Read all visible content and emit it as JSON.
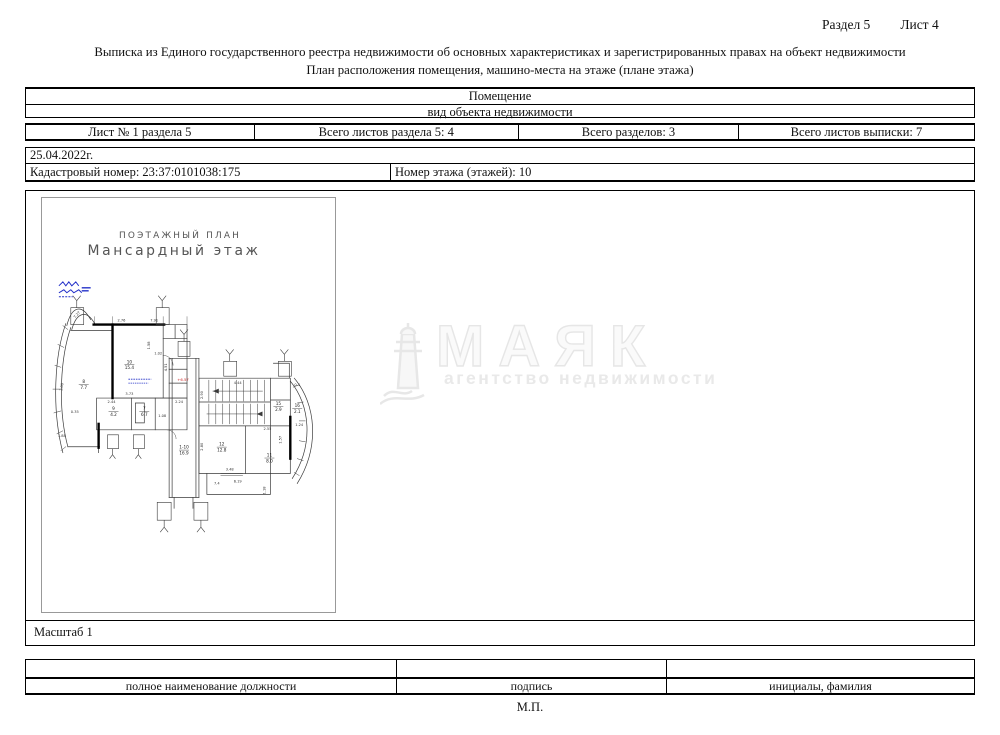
{
  "header": {
    "section": "Раздел 5",
    "sheet": "Лист 4"
  },
  "titles": {
    "line1": "Выписка из Единого государственного реестра недвижимости об основных характеристиках и зарегистрированных правах на объект недвижимости",
    "line2": "План расположения помещения, машино-места на этаже (плане этажа)"
  },
  "object_table": {
    "type_value": "Помещение",
    "type_caption": "вид объекта недвижимости",
    "cells": [
      "Лист № 1 раздела 5",
      "Всего листов раздела 5: 4",
      "Всего разделов: 3",
      "Всего листов выписки: 7"
    ]
  },
  "info": {
    "date": "25.04.2022г.",
    "cadastral": "Кадастровый номер: 23:37:0101038:175",
    "floor": "Номер этажа (этажей): 10"
  },
  "plan": {
    "title_caps": "ПОЭТАЖНЫЙ ПЛАН",
    "subtitle": "Мансардный этаж",
    "scale": "Масштаб 1",
    "ink_colors": {
      "blue_stamp": "#2330c8",
      "red_mark": "#cc2222"
    },
    "elevation": {
      "t": "+6.57",
      "x": 142,
      "y": 184
    },
    "rooms": [
      {
        "num": "8",
        "area": "7.7",
        "x": 42,
        "y": 186
      },
      {
        "num": "10",
        "area": "15.4",
        "x": 88,
        "y": 166
      },
      {
        "num": "9",
        "area": "4.2",
        "x": 72,
        "y": 213
      },
      {
        "num": "7",
        "area": "6.7",
        "x": 103,
        "y": 213
      },
      {
        "num": "1-10",
        "area": "16.9",
        "x": 143,
        "y": 252
      },
      {
        "num": "15",
        "area": "2.9",
        "x": 238,
        "y": 208
      },
      {
        "num": "16",
        "area": "2.1",
        "x": 257,
        "y": 210
      },
      {
        "num": "12",
        "area": "12.8",
        "x": 181,
        "y": 249
      },
      {
        "num": "11",
        "area": "8.0",
        "x": 229,
        "y": 260
      }
    ],
    "dims": [
      {
        "t": "7.27",
        "x": 36,
        "y": 118,
        "r": -48
      },
      {
        "t": "2.76",
        "x": 80,
        "y": 124
      },
      {
        "t": "7.91",
        "x": 113,
        "y": 124
      },
      {
        "t": "1.58",
        "x": 109,
        "y": 148,
        "r": -90
      },
      {
        "t": "1.02",
        "x": 117,
        "y": 157
      },
      {
        "t": "4.51",
        "x": 126,
        "y": 170,
        "r": -90
      },
      {
        "t": "3.73",
        "x": 88,
        "y": 198
      },
      {
        "t": "3.00",
        "x": 21,
        "y": 190,
        "r": -80
      },
      {
        "t": "2.44",
        "x": 70,
        "y": 206
      },
      {
        "t": "2.24",
        "x": 138,
        "y": 206
      },
      {
        "t": "1.08",
        "x": 121,
        "y": 220
      },
      {
        "t": "0.35",
        "x": 33,
        "y": 216
      },
      {
        "t": "1.88",
        "x": 20,
        "y": 240
      },
      {
        "t": "2.90",
        "x": 162,
        "y": 198,
        "r": -90
      },
      {
        "t": "4.44",
        "x": 197,
        "y": 187
      },
      {
        "t": "0.4",
        "x": 257,
        "y": 189
      },
      {
        "t": "2.55",
        "x": 227,
        "y": 233
      },
      {
        "t": "1.24",
        "x": 259,
        "y": 229
      },
      {
        "t": "1.57",
        "x": 241,
        "y": 243,
        "r": -90
      },
      {
        "t": "2.80",
        "x": 162,
        "y": 250,
        "r": -90
      },
      {
        "t": "3.48",
        "x": 189,
        "y": 274
      },
      {
        "t": "6.19",
        "x": 197,
        "y": 286
      },
      {
        "t": "7.4",
        "x": 176,
        "y": 288
      },
      {
        "t": "1.18",
        "x": 225,
        "y": 294,
        "r": -90
      }
    ]
  },
  "watermark": {
    "brand": "МАЯК",
    "tagline": "агентство недвижимости",
    "icon": "lighthouse-icon"
  },
  "sig": {
    "col1": "полное наименование должности",
    "col2": "подпись",
    "col3": "инициалы, фамилия",
    "stamp": "М.П."
  }
}
